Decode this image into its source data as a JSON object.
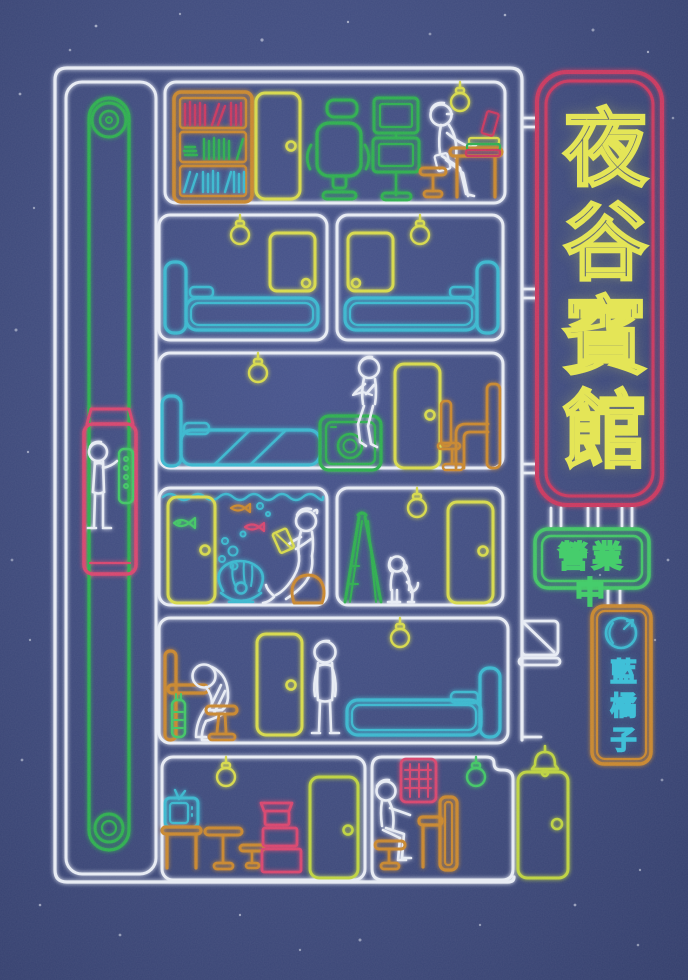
{
  "poster_type": "neon-sign illustrated hotel cross-section cover",
  "palette": {
    "bg": "#3f4b7d",
    "white": "#e7ebf4",
    "yellow": "#d6d94b",
    "lime": "#bdd23f",
    "green": "#2fae50",
    "green-bright": "#42c565",
    "cyan": "#3ab7ce",
    "red": "#c9395f",
    "pink": "#d6446e",
    "orange": "#c8872f",
    "sign-yellow": "#e4e557",
    "sign-green": "#46cd6c",
    "sign-cyan": "#40c0d8"
  },
  "signs": {
    "hotel_sign": {
      "text": "夜谷賓館",
      "text_color": "#e4e557",
      "border_color": "#c9395f"
    },
    "open_sign": {
      "text": "營業中",
      "text_color": "#46cd6c",
      "border_color": "#42c565"
    },
    "author_sign": {
      "text": "藍橘子",
      "text_color": "#40c0d8",
      "border_color": "#c8872f",
      "icon": "orange-fruit-icon"
    }
  },
  "scene": {
    "elevator": {
      "shaft_color": "green",
      "car_color": "pink",
      "occupant": "person pressing green button panel"
    },
    "floors_top_to_bottom": [
      {
        "rooms": [
          {
            "name": "study",
            "items": [
              "bookshelf with red, green and cyan books",
              "door",
              "gaming chair",
              "dual stacked monitors",
              "person reading on stool at desk",
              "stack of books",
              "hanging light bulb"
            ]
          }
        ]
      },
      {
        "rooms": [
          {
            "name": "bedroom-left",
            "items": [
              "bed",
              "door",
              "hanging light bulb"
            ]
          },
          {
            "name": "bedroom-right",
            "items": [
              "door",
              "bed",
              "hanging light bulb"
            ]
          }
        ]
      },
      {
        "rooms": [
          {
            "name": "laundry-bedroom",
            "items": [
              "bed",
              "hanging light bulb",
              "person sitting on washing machine",
              "washing machine",
              "door",
              "desk and chair"
            ]
          }
        ]
      },
      {
        "rooms": [
          {
            "name": "aquarium-room",
            "items": [
              "door",
              "green fish",
              "orange fish",
              "red fish",
              "bubbles",
              "giant clam with pearl",
              "mermaid figure reading yellow book",
              "rock"
            ]
          },
          {
            "name": "ladder-room",
            "items": [
              "stepladder",
              "sitting dog",
              "hanging light bulb",
              "door"
            ]
          }
        ]
      },
      {
        "rooms": [
          {
            "name": "hallway-bedroom",
            "items": [
              "desk",
              "green bottle",
              "person slumped on stool",
              "door",
              "person standing",
              "hanging light bulb",
              "bed"
            ]
          }
        ]
      },
      {
        "rooms": [
          {
            "name": "lobby",
            "items": [
              "television on stand",
              "pedestal table",
              "stool",
              "stacked pink boxes",
              "hanging light bulb",
              "door"
            ]
          },
          {
            "name": "reception",
            "items": [
              "red key rack",
              "receptionist on stool",
              "reception counter",
              "green hanging light bulb"
            ]
          }
        ]
      }
    ],
    "entrance": {
      "items": [
        "doorbell",
        "entrance door"
      ]
    },
    "wall_fixtures": [
      "mail chute",
      "sign mounting brackets"
    ]
  }
}
